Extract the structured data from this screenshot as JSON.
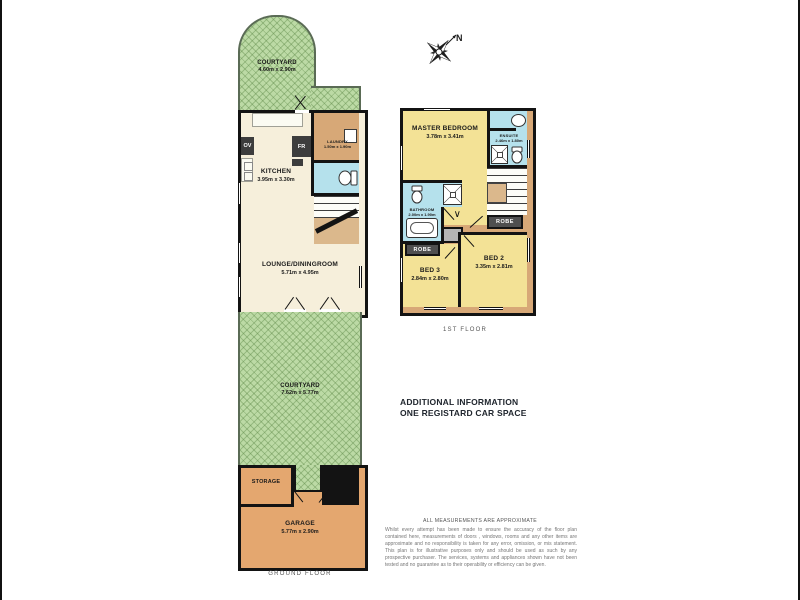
{
  "compass": {
    "north_label": "N"
  },
  "glyphs": {
    "chevron": "∨"
  },
  "ground_floor": {
    "floor_label": "GROUND FLOOR",
    "courtyard_top": {
      "name": "COURTYARD",
      "dims": "4.60m x 2.90m"
    },
    "kitchen": {
      "name": "KITCHEN",
      "dims": "3.95m x 3.30m",
      "oven_label": "OV",
      "fridge_label": "FR"
    },
    "laundry": {
      "name": "LAUNDRY",
      "dims": "1.50m x 1.90m"
    },
    "lounge": {
      "name": "LOUNGE/DININGROOM",
      "dims": "5.71m x 4.95m"
    },
    "courtyard_main": {
      "name": "COURTYARD",
      "dims": "7.62m x 5.77m"
    },
    "storage": {
      "name": "STORAGE"
    },
    "garage": {
      "name": "GARAGE",
      "dims": "5.77m x 2.90m"
    }
  },
  "first_floor": {
    "floor_label": "1ST FLOOR",
    "master_bedroom": {
      "name": "MASTER BEDROOM",
      "dims": "3.78m x 3.41m"
    },
    "ensuite": {
      "name": "ENSUITE",
      "dims": "2.46m x 1.80m"
    },
    "bathroom": {
      "name": "BATHROOM",
      "dims": "2.00m x 1.90m"
    },
    "bed2": {
      "name": "BED 2",
      "dims": "3.35m x 2.81m"
    },
    "bed3": {
      "name": "BED 3",
      "dims": "2.84m x 2.80m"
    },
    "robe_master": "ROBE",
    "robe_hall": "ROBE",
    "robe_bed3": "ROBE"
  },
  "notes": {
    "additional_info_line1": "ADDITIONAL INFORMATION",
    "additional_info_line2": "ONE REGISTARD CAR SPACE",
    "measurements_title": "ALL MEASUREMENTS ARE APPROXIMATE",
    "disclaimer": "Whilst every attempt has been made to ensure the accuracy of the floor plan contained here, measurements of doors , windows, rooms and any other items are approximate and no responsibility is taken for any error, omission, or mis statement. This plan is for illustrative purposes only and should be used as such by any prospective purchaser. The services, systems and appliances shown have not been tested and no guarantee as to their operability or efficiency can be given."
  },
  "colors": {
    "courtyard_green": "#bcdaa5",
    "room_cream": "#f6efdb",
    "bedroom_yellow": "#f3e296",
    "bathroom_blue": "#b5e1ec",
    "hall_tan": "#d7a877",
    "garage_tan": "#e4a76f",
    "robe_dark": "#4f4f4f",
    "wall_black": "#131313"
  }
}
